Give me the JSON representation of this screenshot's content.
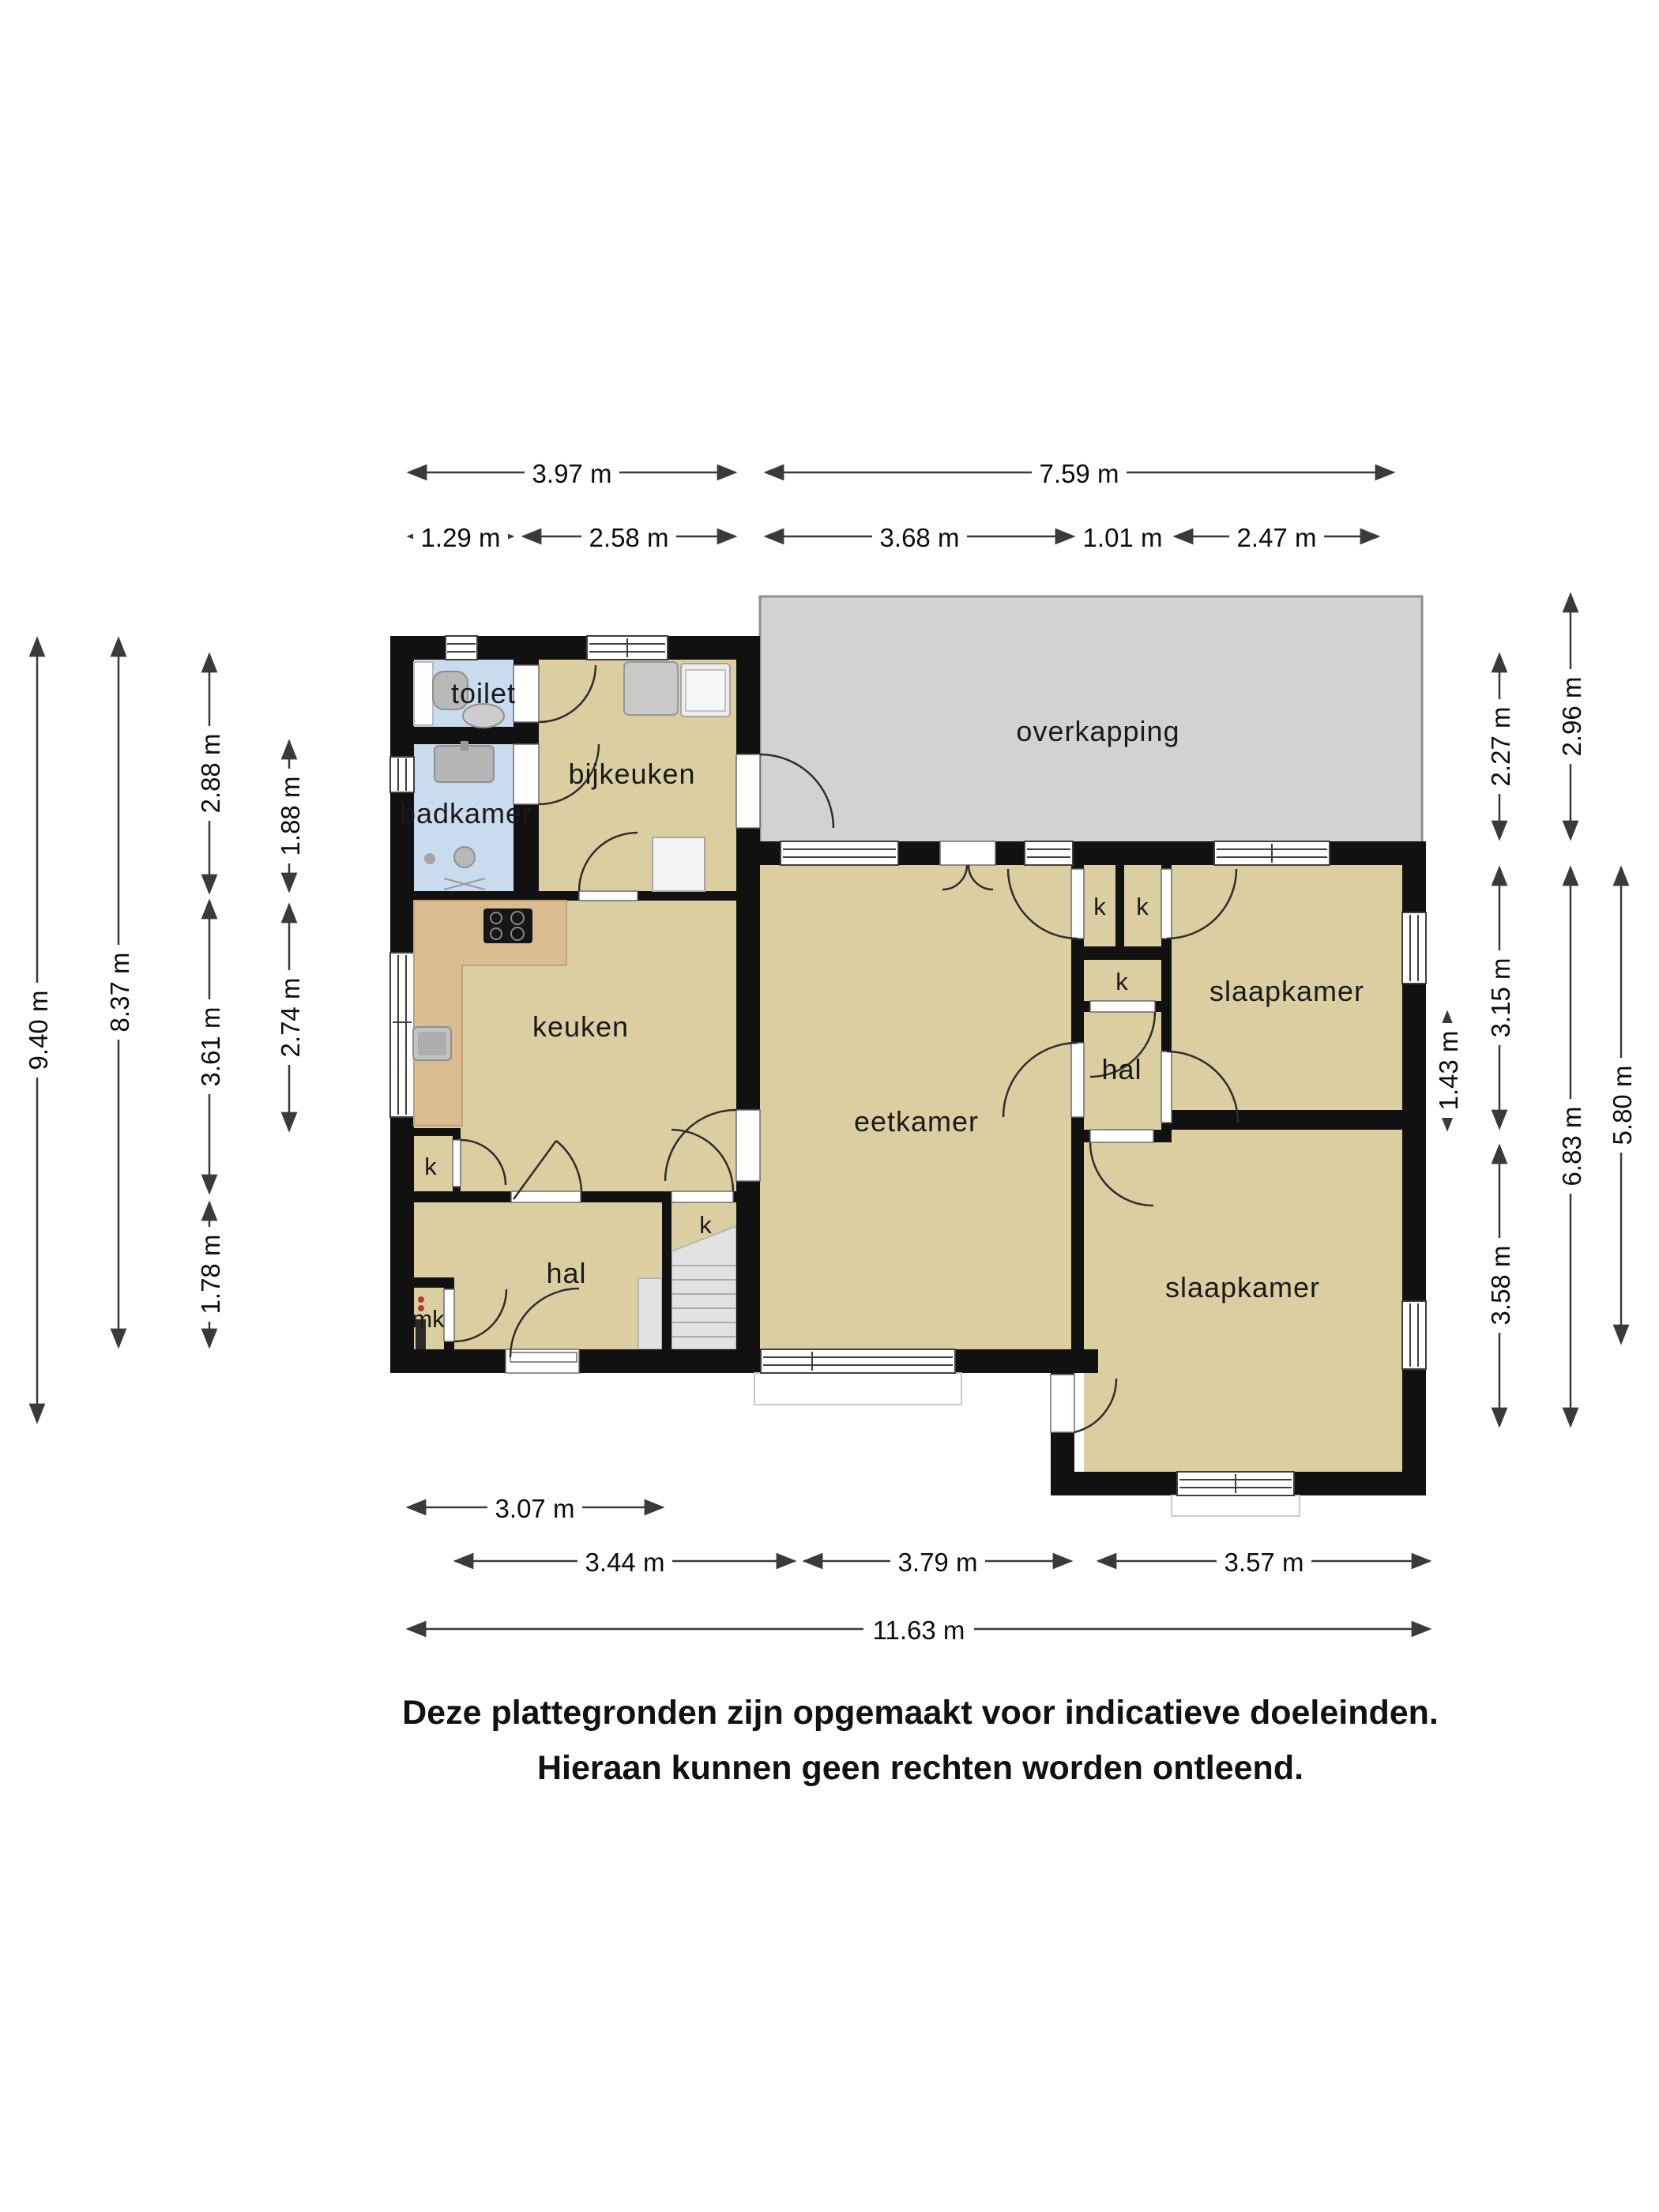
{
  "rooms": {
    "overkapping": "overkapping",
    "toilet": "toilet",
    "badkamer": "badkamer",
    "bijkeuken": "bijkeuken",
    "keuken": "keuken",
    "eetkamer": "eetkamer",
    "hal": "hal",
    "slaapkamer": "slaapkamer",
    "closet": "k",
    "meterkast": "mk"
  },
  "dims": {
    "top": [
      "3.97 m",
      "7.59 m",
      "1.29 m",
      "2.58 m",
      "3.68 m",
      "1.01 m",
      "2.47 m"
    ],
    "left": [
      "9.40 m",
      "8.37 m",
      "2.88 m",
      "3.61 m",
      "1.78 m",
      "1.88 m",
      "2.74 m"
    ],
    "right": [
      "2.96 m",
      "2.27 m",
      "3.15 m",
      "1.43 m",
      "6.83 m",
      "5.80 m",
      "3.58 m"
    ],
    "bottom": [
      "3.07 m",
      "3.44 m",
      "3.79 m",
      "3.57 m",
      "11.63 m"
    ]
  },
  "footer": {
    "line1": "Deze plattegronden zijn opgemaakt voor indicatieve doeleinden.",
    "line2": "Hieraan kunnen geen rechten worden ontleend."
  },
  "colors": {
    "wall": "#111111",
    "room": "#dbcfa2",
    "wet": "#c9dcee",
    "cover": "#d2d2d2",
    "counter": "#d9bc90",
    "stairs": "#e2e2e2",
    "paper": "#ffffff"
  }
}
